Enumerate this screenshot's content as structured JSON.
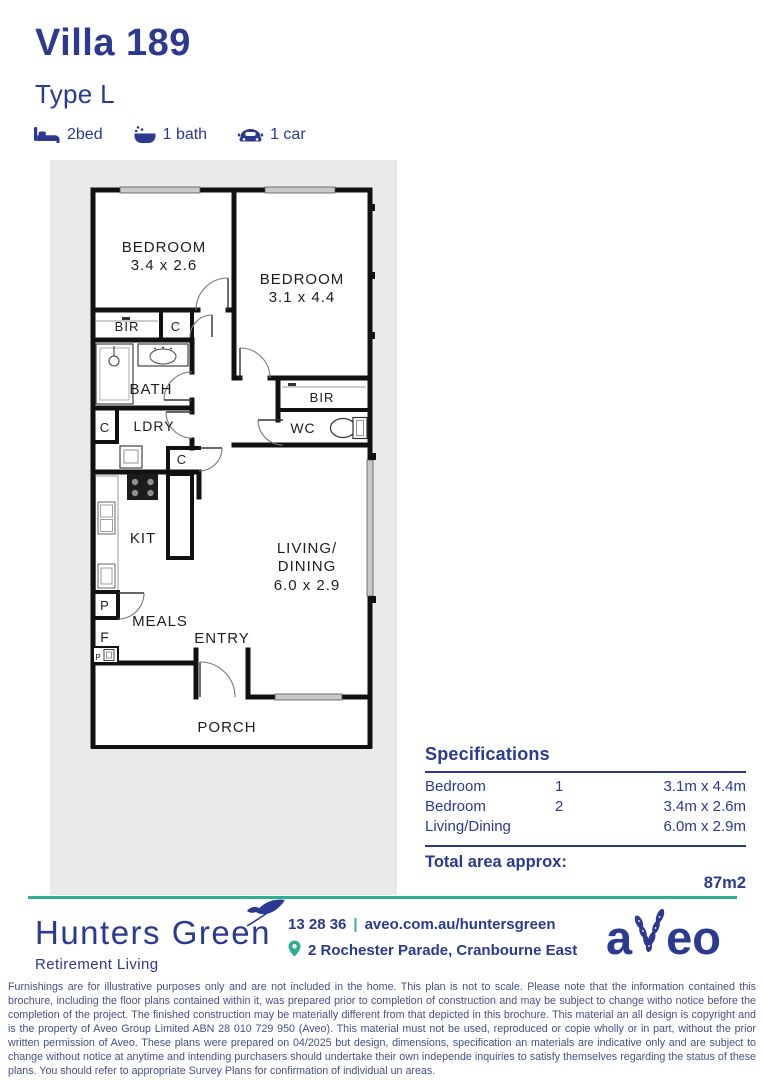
{
  "header": {
    "title": "Villa 189",
    "subtitle": "Type L",
    "features": [
      {
        "icon": "bed-icon",
        "label": "2bed"
      },
      {
        "icon": "bath-icon",
        "label": "1 bath"
      },
      {
        "icon": "car-icon",
        "label": "1 car"
      }
    ]
  },
  "floorplan": {
    "rooms": {
      "bedroom1_name": "BEDROOM",
      "bedroom1_dims": "3.4 x 2.6",
      "bedroom2_name": "BEDROOM",
      "bedroom2_dims": "3.1 x 4.4",
      "bir1": "BIR",
      "cupboard1": "C",
      "bath": "BATH",
      "cupboard2": "C",
      "ldry": "LDRY",
      "cupboard3": "C",
      "kit": "KIT",
      "pantry": "P",
      "fridge": "F",
      "pantry_small": "P",
      "meals": "MEALS",
      "entry": "ENTRY",
      "bir2": "BIR",
      "wc": "WC",
      "living_line1": "LIVING/",
      "living_line2": "DINING",
      "living_dims": "6.0 x 2.9",
      "porch": "PORCH"
    }
  },
  "specifications": {
    "title": "Specifications",
    "rows": [
      {
        "name": "Bedroom",
        "number": "1",
        "size": "3.1m x 4.4m"
      },
      {
        "name": "Bedroom",
        "number": "2",
        "size": "3.4m x 2.6m"
      },
      {
        "name": "Living/Dining",
        "number": "",
        "size": "6.0m x 2.9m"
      }
    ],
    "total_label": "Total area approx:",
    "total_value": "87m2"
  },
  "footer": {
    "brand": "Hunters Green",
    "brand_sub": "Retirement Living",
    "phone": "13 28 36",
    "separator": "|",
    "website": "aveo.com.au/huntersgreen",
    "address": "2 Rochester Parade, Cranbourne East",
    "aveo_prefix": "a",
    "aveo_suffix": "eo",
    "disclaimer": "Furnishings are for illustrative purposes only and are not included in the home. This plan is not to scale. Please note that the information contained this brochure, including the floor plans contained within it, was prepared prior to completion of construction and may be subject to change witho notice before the completion of the project. The finished construction may be materially different from that depicted in this brochure. This material an all design is copyright and is the property of Aveo Group Limited ABN 28 010 729 950 (Aveo). This material must not be used, reproduced or copie wholly or in part, without the prior written permission of Aveo. These plans were prepared on 04/2025 but design, dimensions, specification an materials are indicative only and are subject to change without notice at anytime and intending purchasers should undertake their own independe inquiries to satisfy themselves regarding the status of these plans. You should refer to appropriate Survey Plans for confirmation of individual un areas."
  },
  "colors": {
    "navy": "#2b3990",
    "teal": "#2fae93",
    "plan_ink": "#1d1d1d",
    "panel_gray": "#eaeaeb"
  }
}
